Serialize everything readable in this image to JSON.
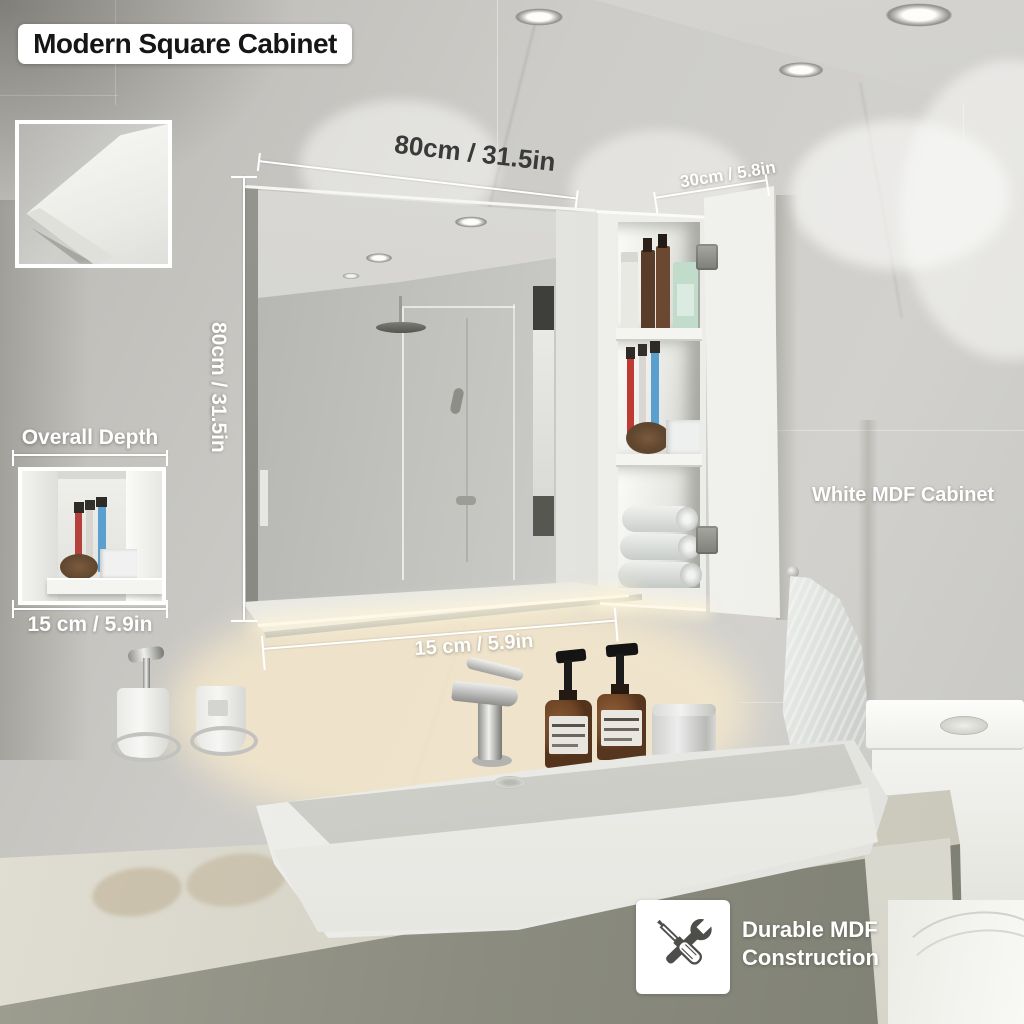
{
  "title": "Modern Square Cabinet",
  "annotations": {
    "width_top": "80cm / 31.5in",
    "height_side": "80cm / 31.5in",
    "door_width": "30cm / 5.8in",
    "shelf_depth": "15 cm / 5.9in",
    "overall_depth": {
      "label": "Overall Depth",
      "value": "15 cm / 5.9in"
    },
    "material_label": "White MDF Cabinet",
    "construction": {
      "line1": "Durable MDF",
      "line2": "Construction"
    }
  },
  "icons": {
    "construction_icon": "crossed-screwdriver-and-wrench"
  },
  "colors": {
    "wall": "#c9c8c4",
    "cabinet_white": "#f2f2ef",
    "counter_face": "#8c8d80",
    "amber_bottle": "#6e4526",
    "warm_glow": "#f2e8d5",
    "text_dark": "#3a3a3a",
    "text_light": "#ffffff"
  }
}
